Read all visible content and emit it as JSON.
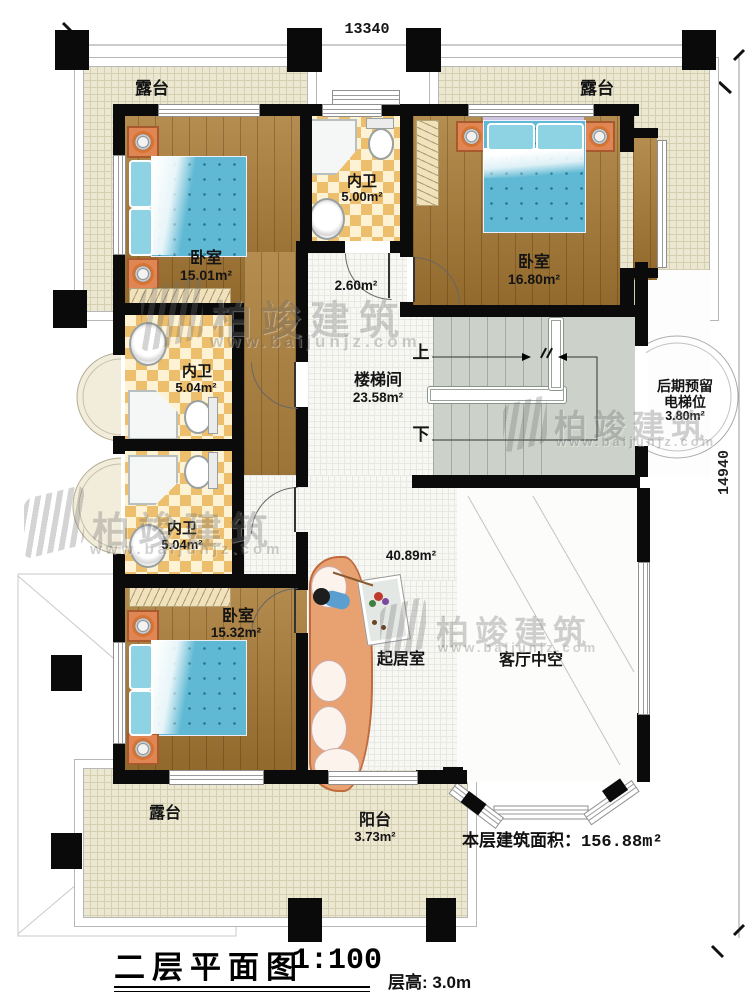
{
  "title_block": {
    "title": "二层平面图",
    "scale": "1:100",
    "floor_height": "层高: 3.0m"
  },
  "area_note": {
    "label": "本层建筑面积：",
    "value": "156.88m²"
  },
  "dimensions": {
    "top": "13340",
    "right": "14940"
  },
  "rooms": {
    "terrace_top_left": {
      "name": "露台"
    },
    "terrace_top_right": {
      "name": "露台"
    },
    "terrace_bottom": {
      "name": "露台"
    },
    "balcony": {
      "name": "阳台",
      "area": "3.73m²"
    },
    "bedroom_top_left": {
      "name": "卧室",
      "area": "15.01m²"
    },
    "bedroom_top_right": {
      "name": "卧室",
      "area": "16.80m²"
    },
    "bedroom_bottom_left": {
      "name": "卧室",
      "area": "15.32m²"
    },
    "bath_top": {
      "name": "内卫",
      "area": "5.00m²"
    },
    "bath_mid": {
      "name": "内卫",
      "area": "5.04m²"
    },
    "bath_low": {
      "name": "内卫",
      "area": "5.04m²"
    },
    "corridor": {
      "area": "2.60m²"
    },
    "stairwell": {
      "name": "楼梯间",
      "area": "23.58m²"
    },
    "elevator": {
      "name_line1": "后期预留",
      "name_line2": "电梯位",
      "area": "3.80m²"
    },
    "living": {
      "name": "起居室",
      "area": "40.89m²"
    },
    "void": {
      "name": "客厅中空"
    }
  },
  "stairs": {
    "up": "上",
    "down": "下"
  },
  "watermark": {
    "brand": "柏竣建筑",
    "url": "www.baijunjz.com"
  },
  "colors": {
    "wall": "#0b0b0b",
    "wood_floor": "#a97a33",
    "tile_accent": "#edbf6d",
    "bed": "#5fb9d4",
    "terrace": "#ebe7d1"
  }
}
